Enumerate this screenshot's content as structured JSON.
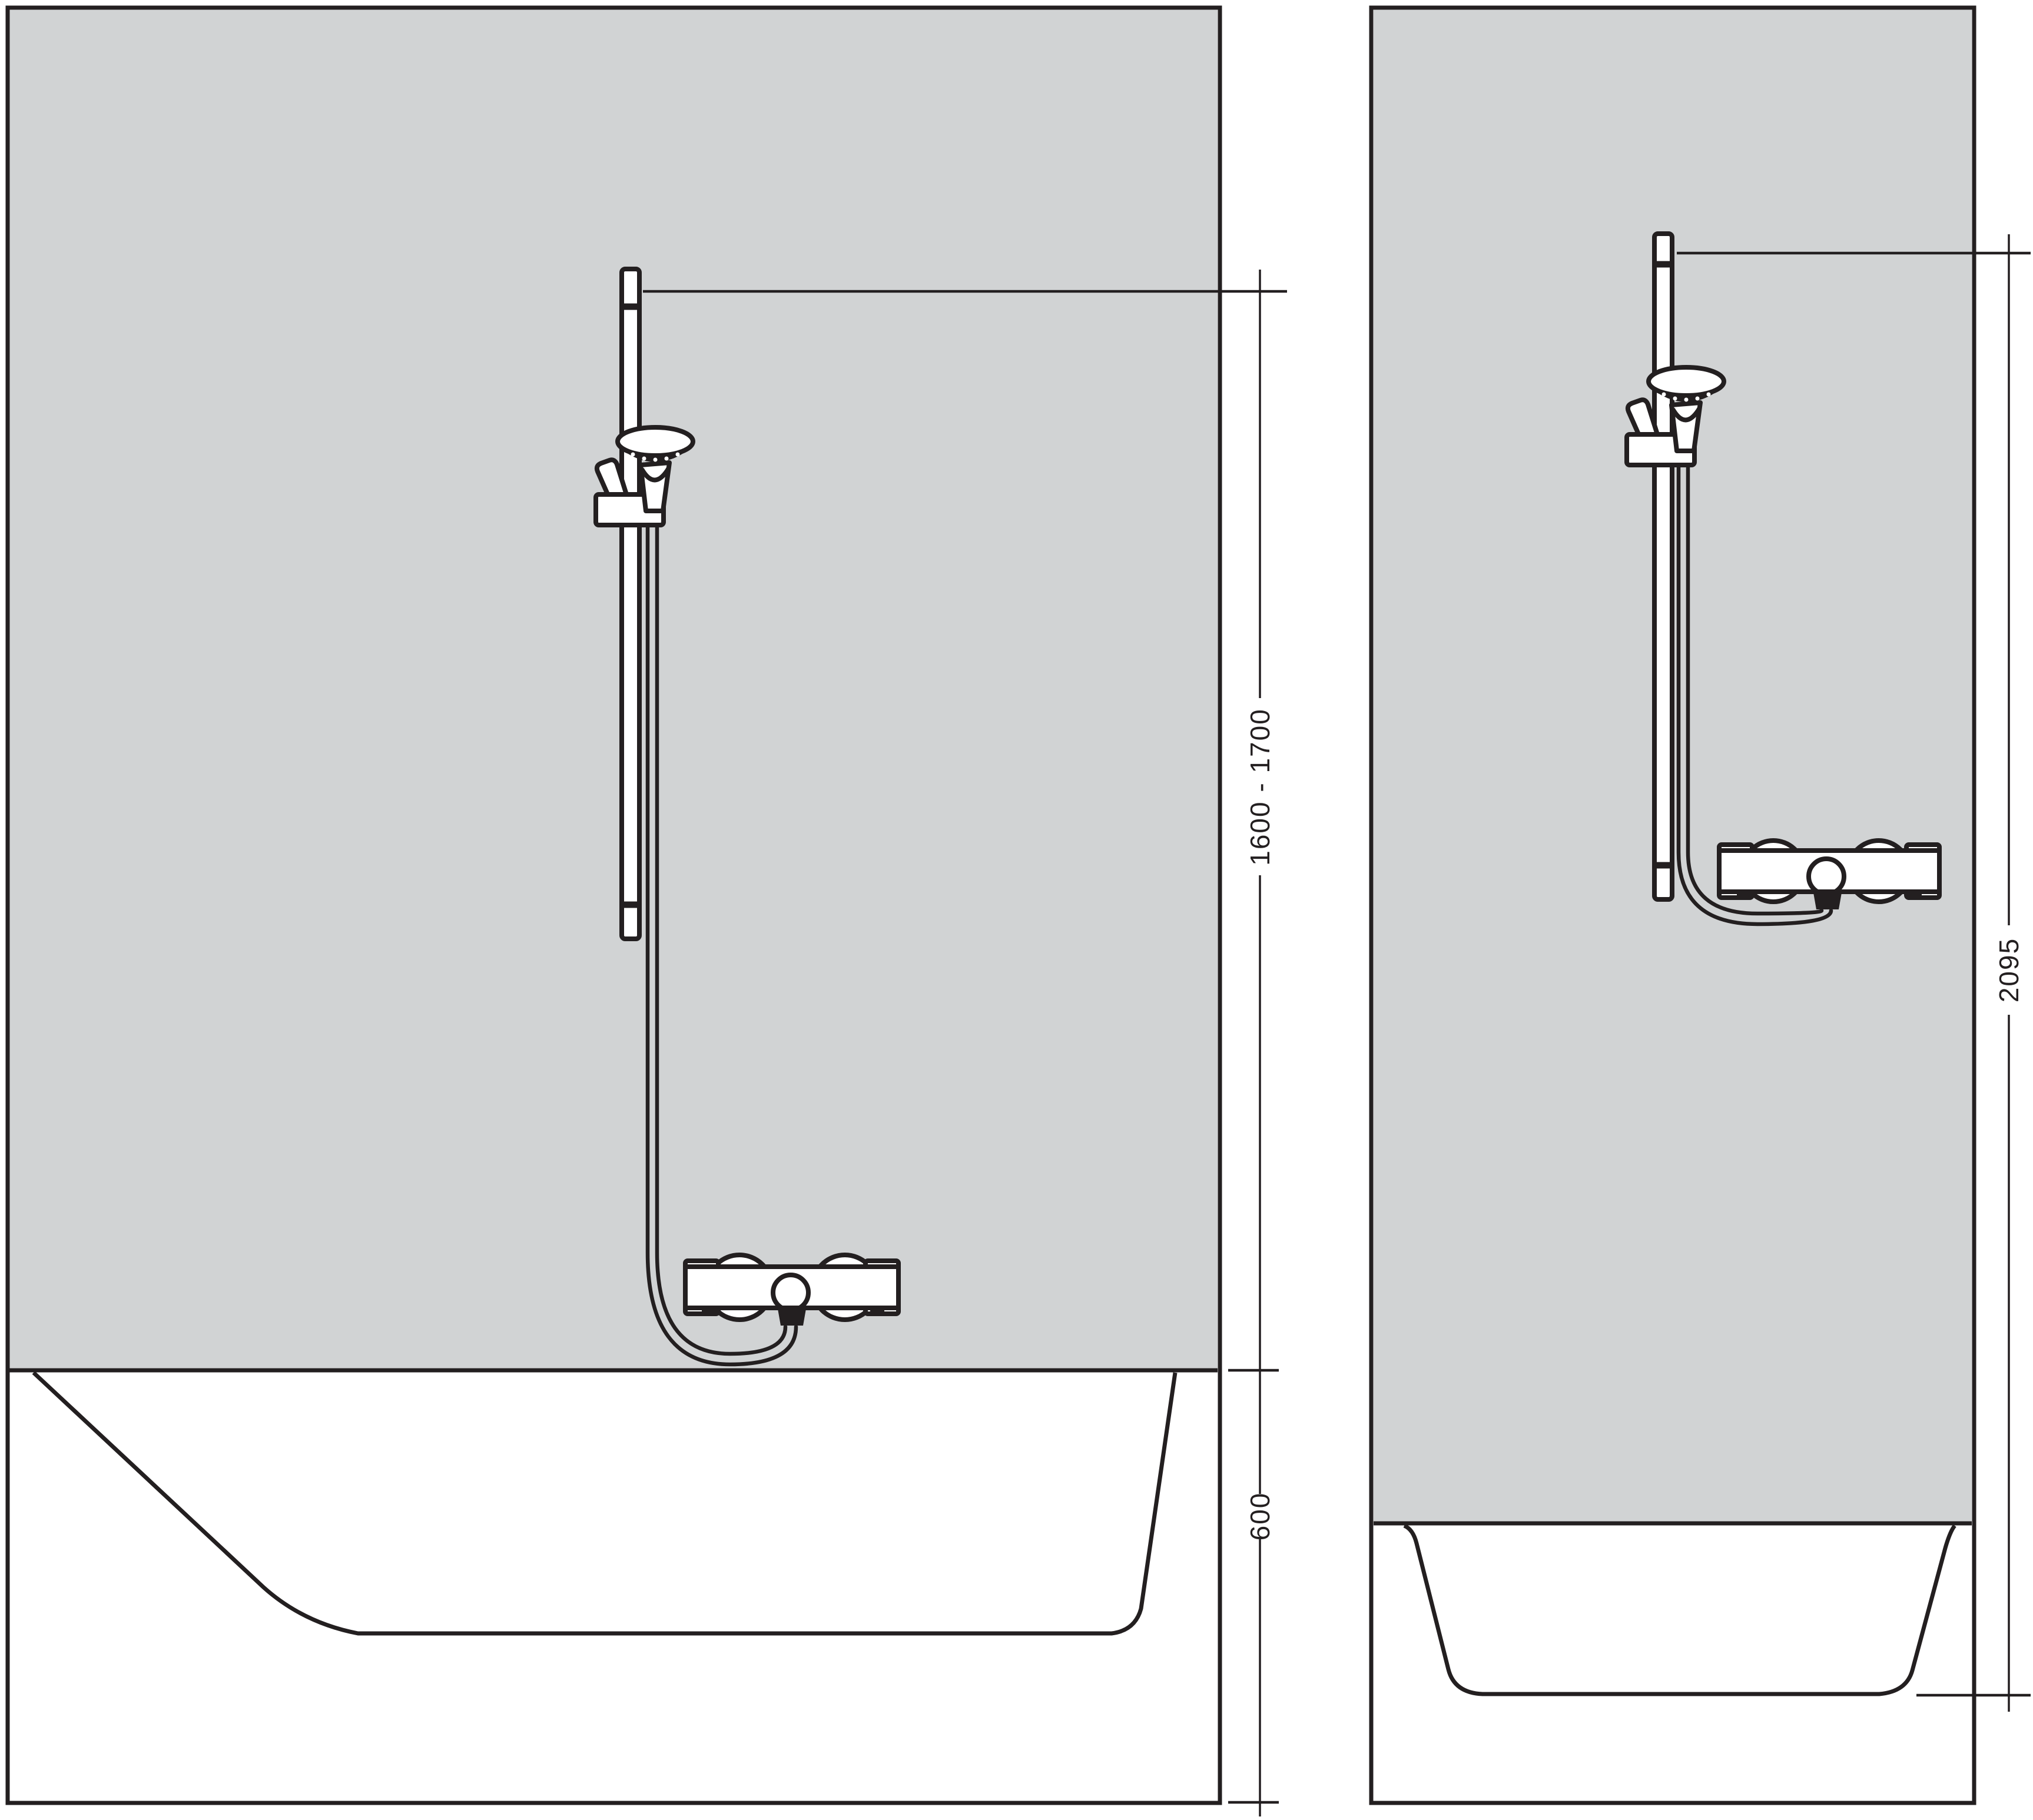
{
  "colors": {
    "wall": "#d1d3d4",
    "line": "#231f20",
    "background": "#ffffff"
  },
  "panels": {
    "bathtub": {
      "dimensions": {
        "mounting_height": {
          "value": "1600 - 1700"
        },
        "rim_to_floor": {
          "value": "600"
        }
      }
    },
    "shower_tray": {
      "dimensions": {
        "overall_height": {
          "value": "2095"
        }
      }
    }
  }
}
